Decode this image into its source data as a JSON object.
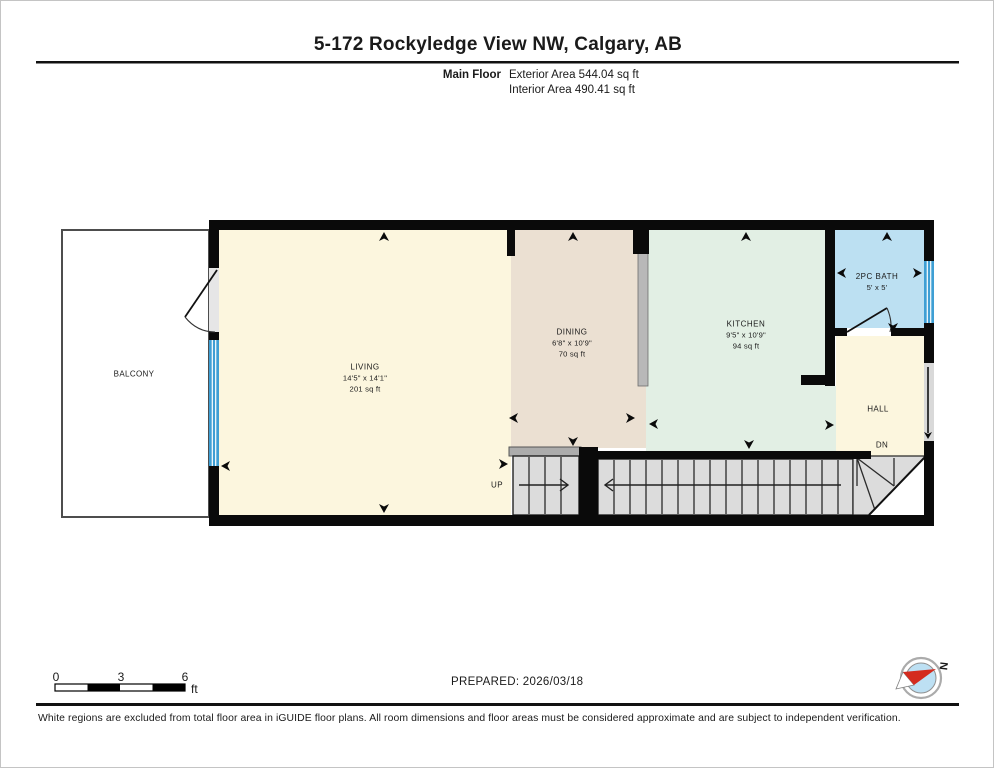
{
  "header": {
    "title": "5-172 Rockyledge View NW, Calgary, AB",
    "floor_label": "Main Floor",
    "exterior_area": "Exterior Area 544.04 sq ft",
    "interior_area": "Interior Area 490.41 sq ft"
  },
  "rooms": {
    "balcony": {
      "name": "BALCONY"
    },
    "living": {
      "name": "LIVING",
      "dimensions": "14'5\" x 14'1\"",
      "area": "201 sq ft"
    },
    "dining": {
      "name": "DINING",
      "dimensions": "6'8\" x 10'9\"",
      "area": "70 sq ft"
    },
    "kitchen": {
      "name": "KITCHEN",
      "dimensions": "9'5\" x 10'9\"",
      "area": "94 sq ft"
    },
    "bath": {
      "name": "2PC BATH",
      "dimensions": "5' x 5'"
    },
    "hall": {
      "name": "HALL"
    }
  },
  "stairs": {
    "up": "UP",
    "down": "DN"
  },
  "scale_bar": {
    "tick_0": "0",
    "tick_3": "3",
    "tick_6": "6",
    "unit": "ft"
  },
  "prepared_label": "PREPARED: 2026/03/18",
  "compass": {
    "north": "N"
  },
  "footer_disclaimer": "White regions are excluded from total floor area in iGUIDE floor plans. All room dimensions and floor areas must be considered approximate and are subject to independent verification.",
  "colors": {
    "living_floor": "#FCF6DE",
    "dining_floor": "#EBE0D2",
    "kitchen_floor": "#E2EFE4",
    "bath_floor": "#BCE0F2",
    "hall_floor": "#FCF6DE",
    "stair_tread": "#DCDCDC",
    "window_blue": "#3E9FD4",
    "wall_black": "#0A0A0A",
    "compass_red": "#D42B1E"
  }
}
